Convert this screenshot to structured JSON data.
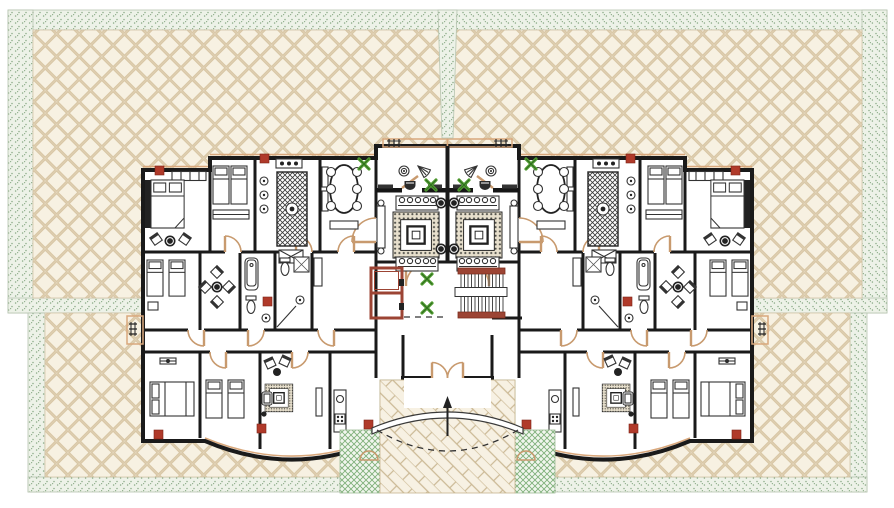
{
  "document": {
    "type": "architectural-floor-plan",
    "description": "Symmetrical residential typical floor plan: two mirrored apartments around a central core with elevator and stair, entrance porch with herringbone forecourt, and tiled roof terraces with planted borders"
  },
  "colors": {
    "wall": "#1a1a1a",
    "line": "#333333",
    "door_tan": "#c89a6e",
    "roof_tan": "#d9a87c",
    "tile_fill": "#f7f1e2",
    "tile_line": "#d8c6a4",
    "stipple_bg": "#edf2e8",
    "stipple_dot": "#8aab86",
    "herring_fill": "#f7f1e3",
    "herring_line": "#cbb995",
    "hatch_green": "#7fb07a",
    "hatch_bg": "#f1f6ee",
    "accent_red": "#b03a2a",
    "core_red": "#9c4434",
    "plant_green": "#55a035",
    "carpet_bg": "#e7dfcc"
  },
  "plan": {
    "wings": [
      "west-apartment",
      "east-apartment"
    ],
    "core": [
      "elevator",
      "u-staircase",
      "entry-lobby",
      "entrance-porch",
      "twin-living-rooms"
    ],
    "outdoor": [
      "roof-terrace-upper-left",
      "roof-terrace-upper-right",
      "roof-terrace-lower-left",
      "roof-terrace-lower-right",
      "herringbone-forecourt",
      "entrance-planters",
      "front-balconies",
      "side-balconies"
    ],
    "rooms_per_apartment": [
      "master-bedroom",
      "twin-bedroom",
      "kitchen",
      "dining-room",
      "living-room",
      "bathroom",
      "wc",
      "sitting-nook",
      "south-bedroom",
      "family-room",
      "kitchenette"
    ],
    "symbols": {
      "door_swings": 24,
      "plant_markers": 6,
      "structural_columns": 12,
      "stair_treads": 13,
      "balconies": 4,
      "elevator_cells": 2
    }
  }
}
